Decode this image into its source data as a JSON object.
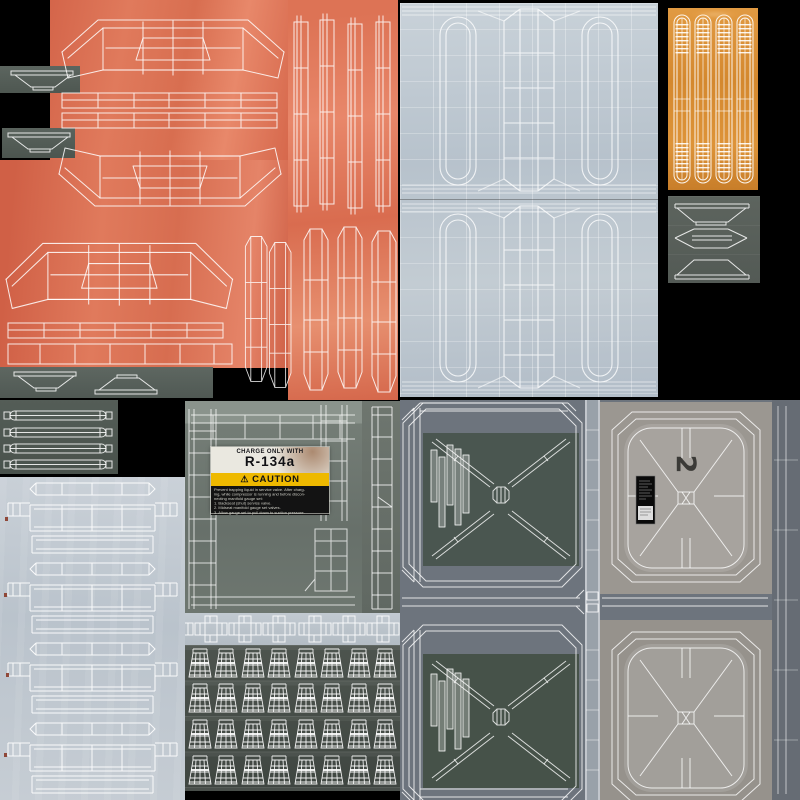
{
  "scene": {
    "description": "UV texture atlas sheet with white wireframe islands over painted metal textures",
    "background": "#000000"
  },
  "colors": {
    "orange_panel": "#d96b4e",
    "amber_panel": "#d4882e",
    "light_metal": "#bfc9d2",
    "pale_panel": "#c4ccd4",
    "green_gray_panel": "#6e7770",
    "dark_strip": "#555e58",
    "cups_panel": "#464d48",
    "quadrant_base": "#6d747d",
    "warm_gray_panel": "#9b9791",
    "inner_square_green": "#4a5650",
    "caution_yellow": "#eeb900",
    "wireframe": "#ffffff"
  },
  "sticker": {
    "header": "CHARGE ONLY WITH",
    "code": "R-134a",
    "warning_glyph": "⚠",
    "caution_label": "CAUTION",
    "body_lines": [
      "Prevent trapping liquid in service valve. After charg-",
      "ing, while compressor is running and before discon-",
      "necting manifold gauge set:",
      "1. Backseat (shut) service valve.",
      "2. Midseat manifold gauge set valves.",
      "3. Allow gauge set to pull down to suction pressure."
    ]
  },
  "stencil": {
    "glyph": "2"
  }
}
